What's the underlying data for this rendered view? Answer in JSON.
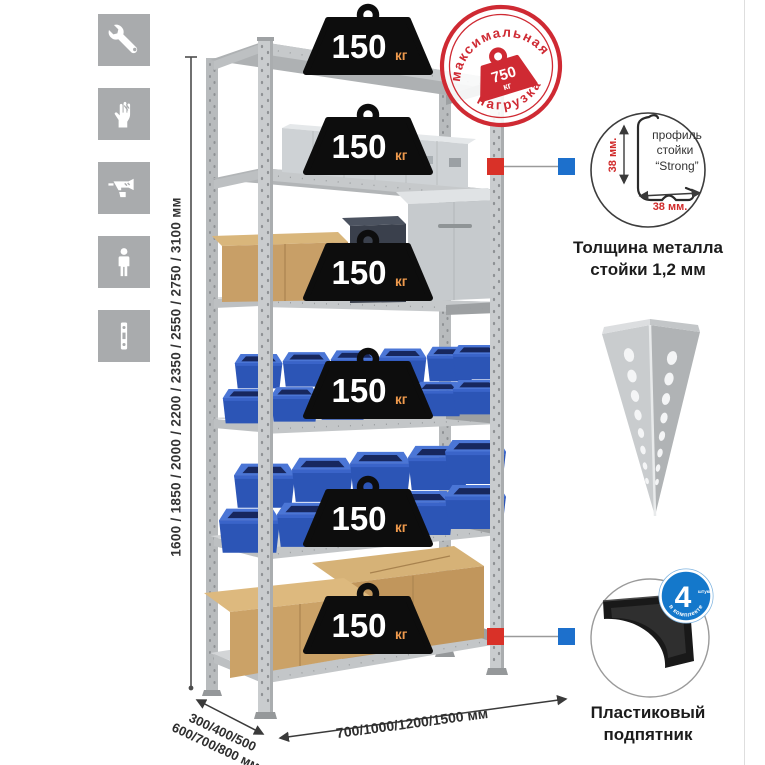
{
  "page": {
    "background": "#ffffff",
    "right_border_color": "#dedede"
  },
  "assembly_icons": [
    {
      "name": "wrench"
    },
    {
      "name": "gloves"
    },
    {
      "name": "drill"
    },
    {
      "name": "person"
    },
    {
      "name": "perforated-profile"
    }
  ],
  "height_dimension": {
    "label": "1600 / 1850 / 2000 / 2200 / 2350 / 2550 / 2750 / 3100 мм"
  },
  "rack": {
    "shelves_count": 6,
    "badges": [
      {
        "value": "150",
        "unit": "кг"
      },
      {
        "value": "150",
        "unit": "кг"
      },
      {
        "value": "150",
        "unit": "кг"
      },
      {
        "value": "150",
        "unit": "кг"
      },
      {
        "value": "150",
        "unit": "кг"
      },
      {
        "value": "150",
        "unit": "кг"
      }
    ]
  },
  "max_load_stamp": {
    "arc_top": "максимальная",
    "arc_bottom": "нагрузка",
    "value": "750",
    "unit": "кг",
    "color": "#cf2a33"
  },
  "profile_callout": {
    "text_lines": [
      "профиль",
      "стойки",
      "“Strong”"
    ],
    "vertical_dim": "38 мм.",
    "horizontal_dim": "38 мм.",
    "caption_lines": [
      "Толщина металла",
      "стойки 1,2 мм"
    ]
  },
  "foot_callout": {
    "badge_value": "4",
    "badge_small_text": "штуки",
    "badge_arc_text": "в комплекте",
    "caption_lines": [
      "Пластиковый",
      "подпятник"
    ]
  },
  "depth_dimension": {
    "lines": [
      "300/400/500",
      "600/700/800 мм"
    ]
  },
  "width_dimension": {
    "label": "700/1000/1200/1500 мм"
  },
  "colors": {
    "stamp_red": "#cf2a33",
    "connector_red": "#d93128",
    "connector_blue": "#1d70cc",
    "bin_blue": "#2c55b6",
    "badge_unit_orange": "#ef9a4d",
    "icon_square_gray": "#a9abad"
  }
}
